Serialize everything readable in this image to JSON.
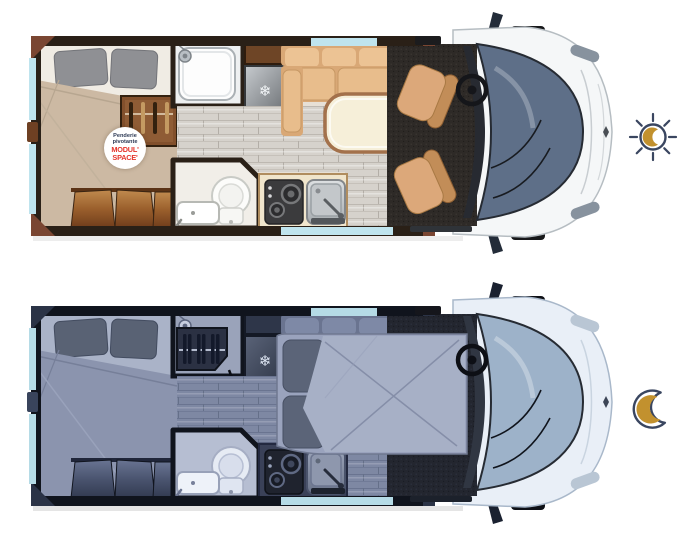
{
  "page": {
    "background": "#ffffff"
  },
  "palette": {
    "badge_red": "#e5342b",
    "badge_navy": "#2e3a55",
    "icon_navy": "#3a4660",
    "icon_gold": "#c2912e",
    "glass_blue": "#bfe4ee",
    "glass_blue_night": "#b5dbe6",
    "day_wall": "#2a2017",
    "day_duvet": "#ccb9a3",
    "day_bench": "#d9a876",
    "day_cab": "#f5f7f8",
    "day_windshield": "#5e6f88",
    "night_wall": "#10141d",
    "night_bed": "#9aa3bd",
    "night_cab": "#e9eff7",
    "night_windshield": "#9db2c9"
  },
  "legend": {
    "day_icon": "sun-with-crescent",
    "night_icon": "crescent-moon"
  },
  "day_plan": {
    "badge": {
      "line1": "Penderie",
      "line2": "pivotante",
      "brand_line1": "MODUL'",
      "brand_line2": "SPACE'"
    },
    "fridge_glyph": "❄"
  },
  "night_plan": {
    "fridge_glyph": "❄"
  }
}
